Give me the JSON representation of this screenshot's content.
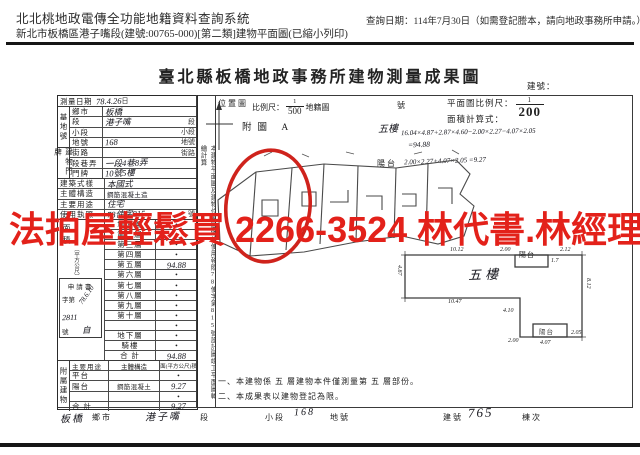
{
  "colors": {
    "watermark_red": "#e3211a",
    "annotation_red": "#cf231c",
    "ink": "#1f1f1f"
  },
  "header": {
    "system_title": "北北桃地政電傳全功能地籍資料查詢系統",
    "subtitle": "新北市板橋區港子嘴段(建號:00765-000)[第二類]建物平面圖(已縮小列印)",
    "query_date": "查詢日期：114年7月30日（如需登記謄本，請向地政事務所申請。）"
  },
  "watermark": {
    "text": "法拍屋輕鬆買 2266-3524 林代書.林經理"
  },
  "doc": {
    "title": "臺北縣板橋地政事務所建物測量成果圖",
    "building_no_label": "建號：",
    "survey": {
      "label": "測量日期",
      "value": "78.4.26",
      "suffix": "日"
    },
    "site": {
      "group": "基地號",
      "rows": [
        {
          "label": "鄉市",
          "value": "板橋",
          "suffix": ""
        },
        {
          "label": "段",
          "value": "港子嘴",
          "suffix": "段"
        },
        {
          "label": "小段",
          "value": "",
          "suffix": "小段"
        },
        {
          "label": "地號",
          "value": "168",
          "suffix": "地號"
        }
      ]
    },
    "door": {
      "group": "建物門牌",
      "rows": [
        {
          "label": "街路",
          "value": "",
          "suffix": "街路"
        },
        {
          "label": "段巷弄",
          "value": "一段4巷8弄",
          "suffix": ""
        },
        {
          "label": "門牌",
          "value": "10號5樓",
          "suffix": ""
        }
      ]
    },
    "attrs": {
      "rows": [
        {
          "label": "建築式樣",
          "value": "本國式",
          "suffix": ""
        },
        {
          "label": "主體構造",
          "value": "鋼筋混凝土造",
          "suffix": ""
        },
        {
          "label": "主要用途",
          "value": "住宅",
          "suffix": ""
        },
        {
          "label": "使用執照",
          "value": "78使字815",
          "suffix": "號"
        }
      ]
    },
    "area": {
      "group": "面積",
      "unit": "（平方公尺）",
      "application": {
        "l1": "申請書",
        "l2": "字第",
        "date": "78.6.10",
        "no": "2811",
        "l3": "號",
        "hand": "自"
      },
      "floors": [
        {
          "label": "地面層",
          "value": "•"
        },
        {
          "label": "第二層",
          "value": "•"
        },
        {
          "label": "第三層",
          "value": "•"
        },
        {
          "label": "第四層",
          "value": "•"
        },
        {
          "label": "第五層",
          "value": "94.88"
        },
        {
          "label": "第六層",
          "value": "•"
        },
        {
          "label": "第七層",
          "value": "•"
        },
        {
          "label": "第八層",
          "value": "•"
        },
        {
          "label": "第九層",
          "value": "•"
        },
        {
          "label": "第十層",
          "value": "•"
        },
        {
          "label": "",
          "value": "•"
        },
        {
          "label": "地下層",
          "value": "•"
        },
        {
          "label": "騎樓",
          "value": "•"
        },
        {
          "label": "合 計",
          "value": "94.88"
        }
      ]
    },
    "annex": {
      "group": "附屬建物",
      "headers": [
        "主要用途",
        "主體構造",
        "面(平方公尺)積"
      ],
      "rows": [
        {
          "use": "平台",
          "structure": "",
          "area": "•"
        },
        {
          "use": "陽台",
          "structure": "鋼筋混凝土",
          "area": "9.27"
        },
        {
          "use": "",
          "structure": "",
          "area": "•"
        },
        {
          "use": "合 計",
          "structure": "",
          "area": "9.27"
        }
      ]
    },
    "strip_note": "本建物平面圖及建物位置圖係依使用執照78使字第815號設計圖竣工平面圖轉繪計算",
    "locmap": {
      "label": "位置圖",
      "scale_label": "比例尺：",
      "num": "1",
      "den": "500",
      "suffix": "地籍圖",
      "sheet": "號",
      "fig": "附圖 A",
      "hand_floor": "五樓",
      "balcony": "陽台"
    },
    "plan": {
      "scale_label": "平面圖比例尺：",
      "num": "1",
      "den": "200",
      "calc_label": "面積計算式：",
      "calc1": "16.04×4.87+2.87×4.60−2.00×2.27−4.07×2.05",
      "calc2": "=94.88",
      "calc3": "2.00×2.27+4.07×2.05 =9.27",
      "room": "五樓",
      "balcony": "陽台",
      "balcony2": "陽台",
      "dims": [
        "10.12",
        "2.00",
        "2.12",
        "1.7",
        "4.87",
        "8.12",
        "10.47",
        "4.10",
        "2.00",
        "4.07",
        "2.05"
      ]
    },
    "notes": [
      "一、本建物係 五 層建物本件僅測量第 五 層部份。",
      "二、本成果表以建物登記為限。"
    ],
    "footer": {
      "city": "板橋",
      "city_sfx": "鄉市",
      "sec": "港子嘴",
      "sec_sfx": "段",
      "sub_lbl": "小段",
      "lot": "168",
      "lot_sfx": "地號",
      "bno_lbl": "建號",
      "bno": "765",
      "unit_lbl": "棟次"
    }
  }
}
